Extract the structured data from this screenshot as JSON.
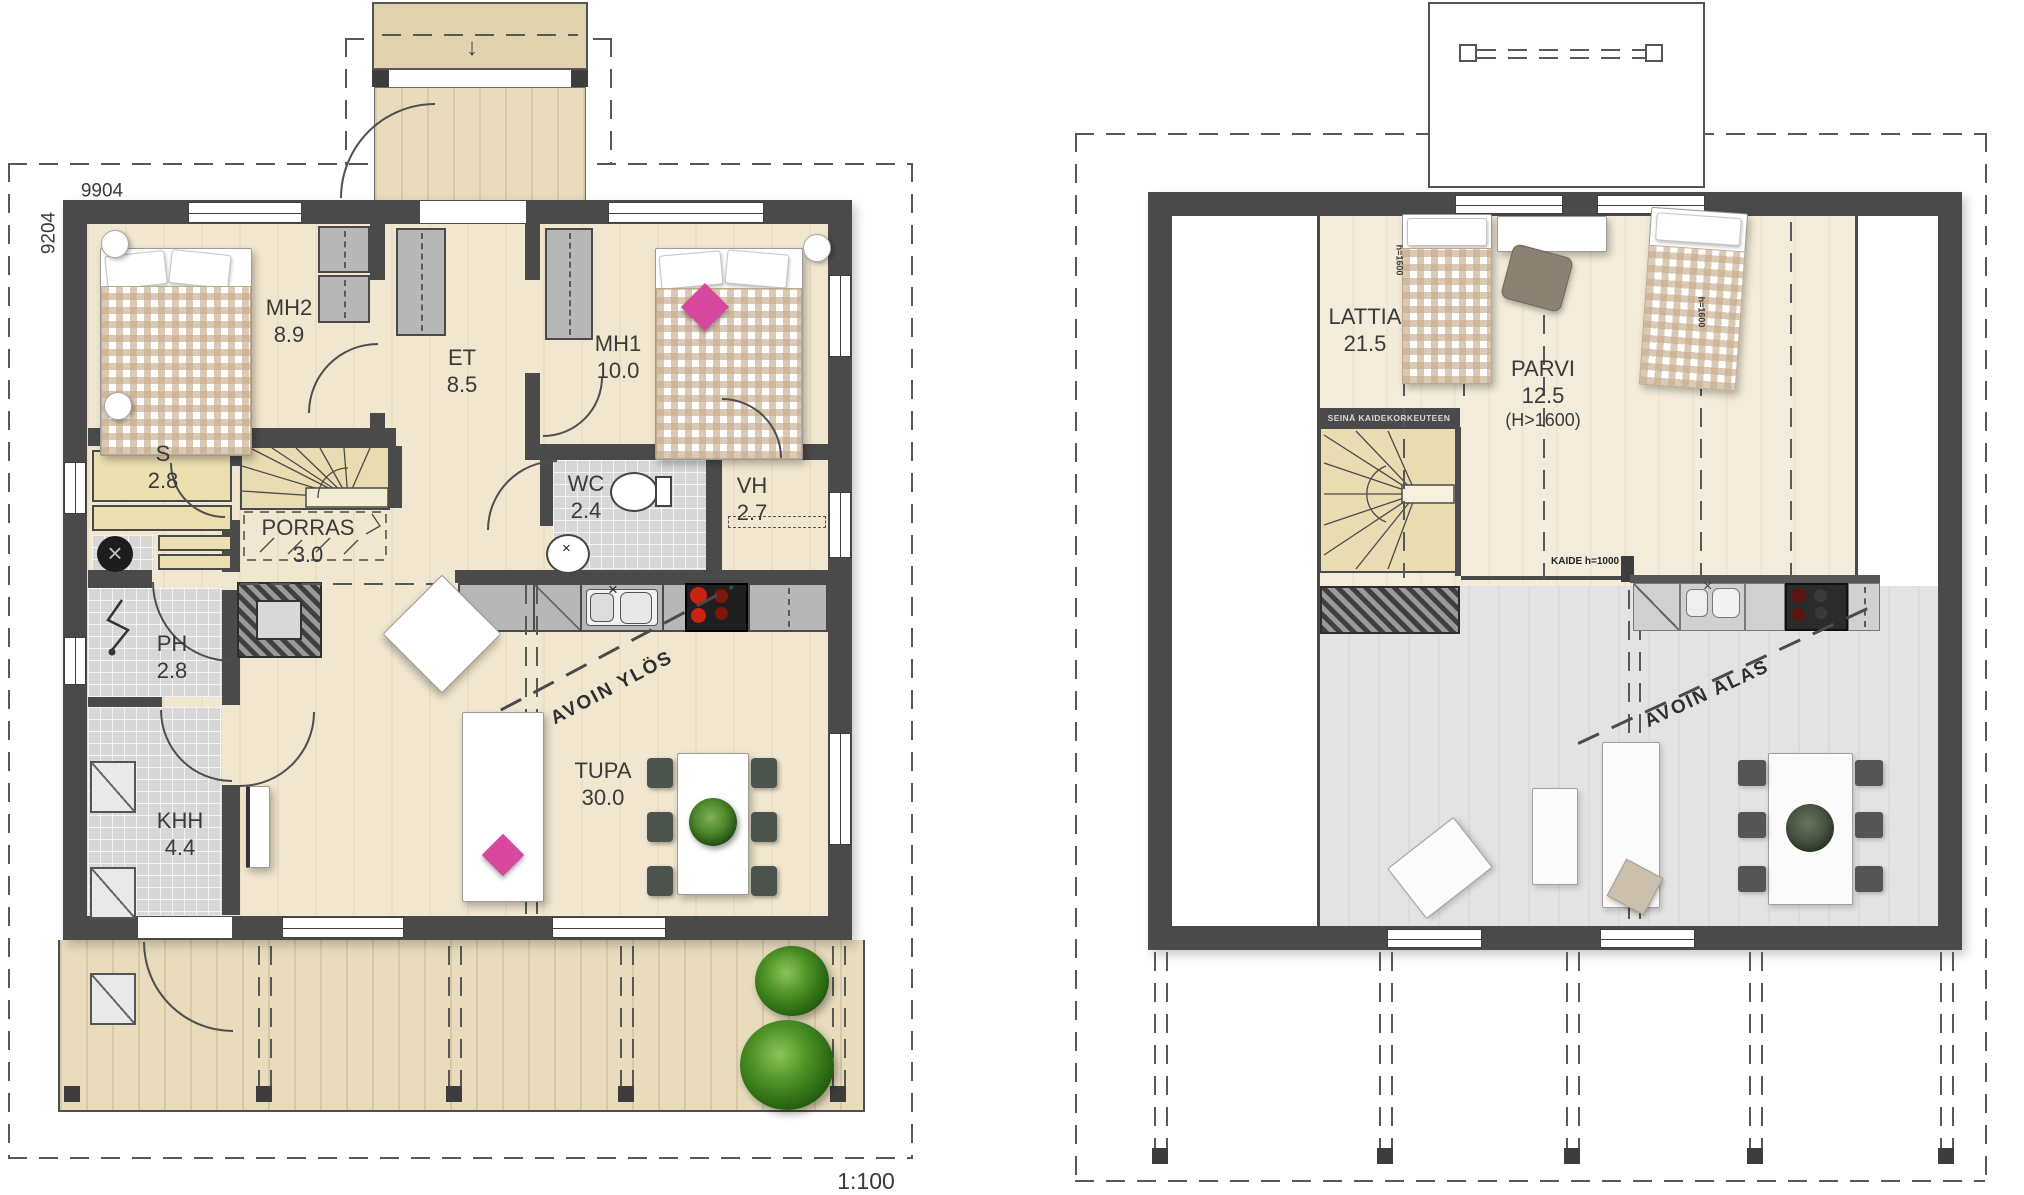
{
  "meta": {
    "scale_label": "1:100",
    "width_dimension": "9904",
    "depth_dimension": "9204"
  },
  "ground_floor": {
    "rooms": {
      "mh2": {
        "label": "MH2",
        "area": "8.9"
      },
      "et": {
        "label": "ET",
        "area": "8.5"
      },
      "mh1": {
        "label": "MH1",
        "area": "10.0"
      },
      "s": {
        "label": "S",
        "area": "2.8"
      },
      "porras": {
        "label": "PORRAS",
        "area": "3.0"
      },
      "wc": {
        "label": "WC",
        "area": "2.4"
      },
      "vh": {
        "label": "VH",
        "area": "2.7"
      },
      "ph": {
        "label": "PH",
        "area": "2.8"
      },
      "khh": {
        "label": "KHH",
        "area": "4.4"
      },
      "tupa": {
        "label": "TUPA",
        "area": "30.0"
      }
    },
    "annotations": {
      "avoin_ylos": "AVOIN YLÖS"
    }
  },
  "upper_floor": {
    "rooms": {
      "lattia": {
        "label": "LATTIA",
        "area": "21.5"
      },
      "parvi": {
        "label": "PARVI",
        "area": "12.5",
        "height_note": "(H>1600)"
      }
    },
    "annotations": {
      "avoin_alas": "AVOIN ALAS",
      "kaide": "KAIDE h=1000",
      "seina_kaide": "SEINÄ KAIDEKORKEUTEEN",
      "h1600_left": "h=1600",
      "h1600_right": "h=1600"
    }
  },
  "colors": {
    "wall": "#4a4a4a",
    "wood_floor": "#f1e6cf",
    "stair_wood": "#e9dcb2",
    "tile": "#d7d7d7",
    "terrace": "#e8dcbd",
    "void": "#e3e3e3",
    "bed_check": "#c7ac8c",
    "accent_pink": "#d6479d",
    "stove_red": "#c8240f",
    "plant_green": "#4e8a2e"
  }
}
